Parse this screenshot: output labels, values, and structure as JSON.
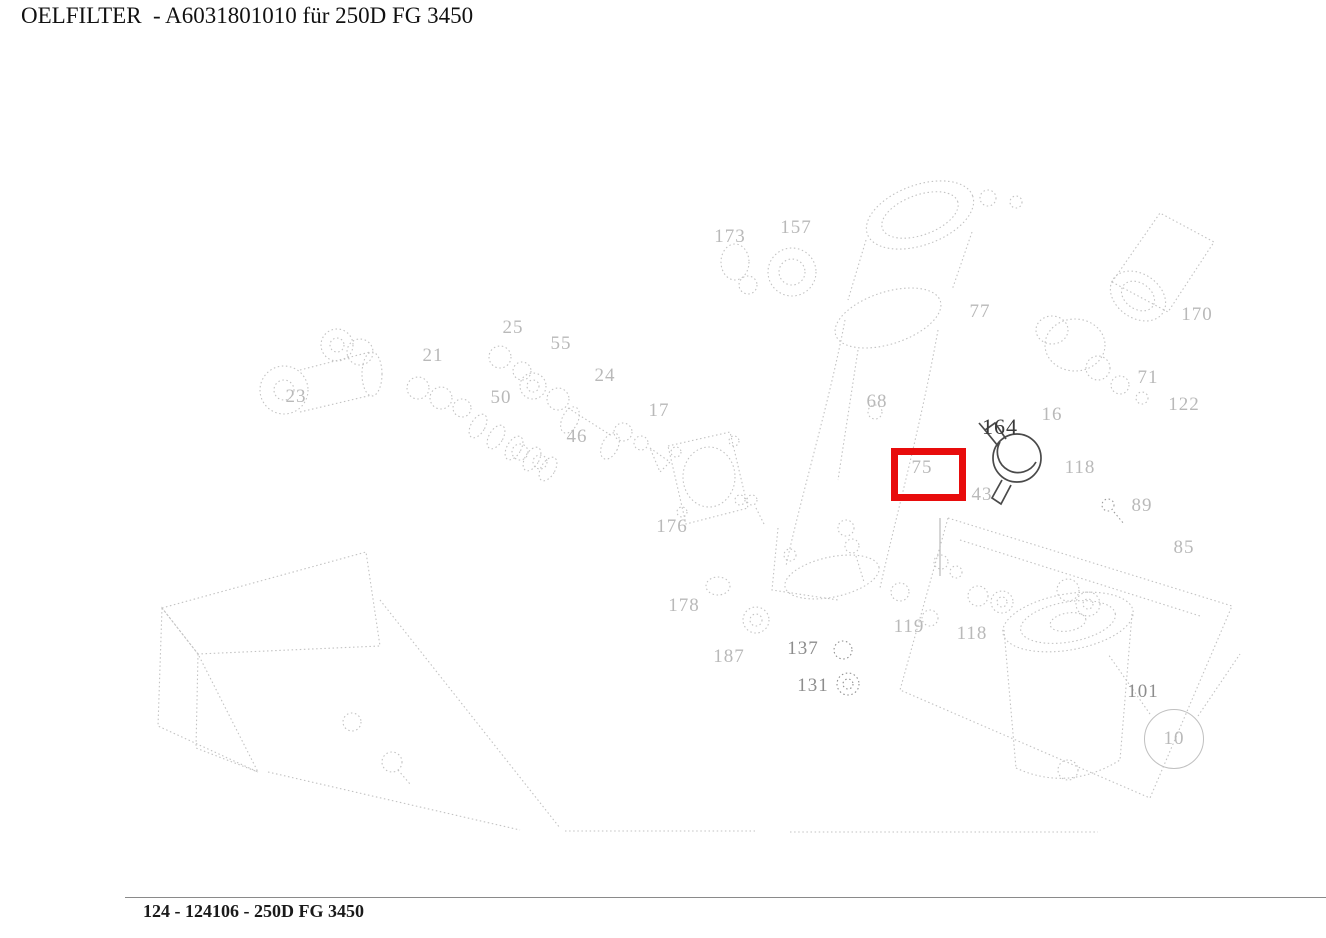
{
  "page": {
    "title": "OELFILTER  - A6031801010 für 250D FG 3450",
    "footer": "124 - 124106 - 250D FG 3450"
  },
  "diagram": {
    "description": "exploded-parts-line-drawing-oil-filter",
    "line_color": "#c2c2c2",
    "emphasis_color": "#4a4a4a",
    "highlight": {
      "part": "75",
      "x": 891,
      "y": 448,
      "width": 61,
      "height": 39,
      "color": "#e80c0c"
    },
    "labels": [
      {
        "text": "173",
        "x": 730,
        "y": 237,
        "tone": "faint"
      },
      {
        "text": "157",
        "x": 796,
        "y": 228,
        "tone": "faint"
      },
      {
        "text": "77",
        "x": 980,
        "y": 312,
        "tone": "faint"
      },
      {
        "text": "170",
        "x": 1197,
        "y": 315,
        "tone": "faint"
      },
      {
        "text": "71",
        "x": 1148,
        "y": 378,
        "tone": "faint"
      },
      {
        "text": "122",
        "x": 1184,
        "y": 405,
        "tone": "faint"
      },
      {
        "text": "16",
        "x": 1052,
        "y": 415,
        "tone": "faint"
      },
      {
        "text": "164",
        "x": 1000,
        "y": 427,
        "tone": "dark"
      },
      {
        "text": "118",
        "x": 1080,
        "y": 468,
        "tone": "faint"
      },
      {
        "text": "89",
        "x": 1142,
        "y": 506,
        "tone": "faint"
      },
      {
        "text": "85",
        "x": 1184,
        "y": 548,
        "tone": "faint"
      },
      {
        "text": "23",
        "x": 296,
        "y": 397,
        "tone": "faint"
      },
      {
        "text": "21",
        "x": 433,
        "y": 356,
        "tone": "faint"
      },
      {
        "text": "25",
        "x": 513,
        "y": 328,
        "tone": "faint"
      },
      {
        "text": "55",
        "x": 561,
        "y": 344,
        "tone": "faint"
      },
      {
        "text": "50",
        "x": 501,
        "y": 398,
        "tone": "faint"
      },
      {
        "text": "24",
        "x": 605,
        "y": 376,
        "tone": "faint"
      },
      {
        "text": "46",
        "x": 577,
        "y": 437,
        "tone": "faint"
      },
      {
        "text": "17",
        "x": 659,
        "y": 411,
        "tone": "faint"
      },
      {
        "text": "176",
        "x": 672,
        "y": 527,
        "tone": "faint"
      },
      {
        "text": "68",
        "x": 877,
        "y": 402,
        "tone": "faint"
      },
      {
        "text": "43",
        "x": 982,
        "y": 495,
        "tone": "faint"
      },
      {
        "text": "75",
        "x": 922,
        "y": 468,
        "tone": "faint"
      },
      {
        "text": "119",
        "x": 909,
        "y": 627,
        "tone": "faint"
      },
      {
        "text": "118",
        "x": 972,
        "y": 634,
        "tone": "faint"
      },
      {
        "text": "178",
        "x": 684,
        "y": 606,
        "tone": "faint"
      },
      {
        "text": "187",
        "x": 729,
        "y": 657,
        "tone": "faint"
      },
      {
        "text": "137",
        "x": 803,
        "y": 649,
        "tone": "medium"
      },
      {
        "text": "131",
        "x": 813,
        "y": 686,
        "tone": "medium"
      },
      {
        "text": "101",
        "x": 1143,
        "y": 692,
        "tone": "medium"
      },
      {
        "text": "10",
        "x": 1174,
        "y": 739,
        "tone": "faint",
        "balloon": true
      }
    ]
  }
}
